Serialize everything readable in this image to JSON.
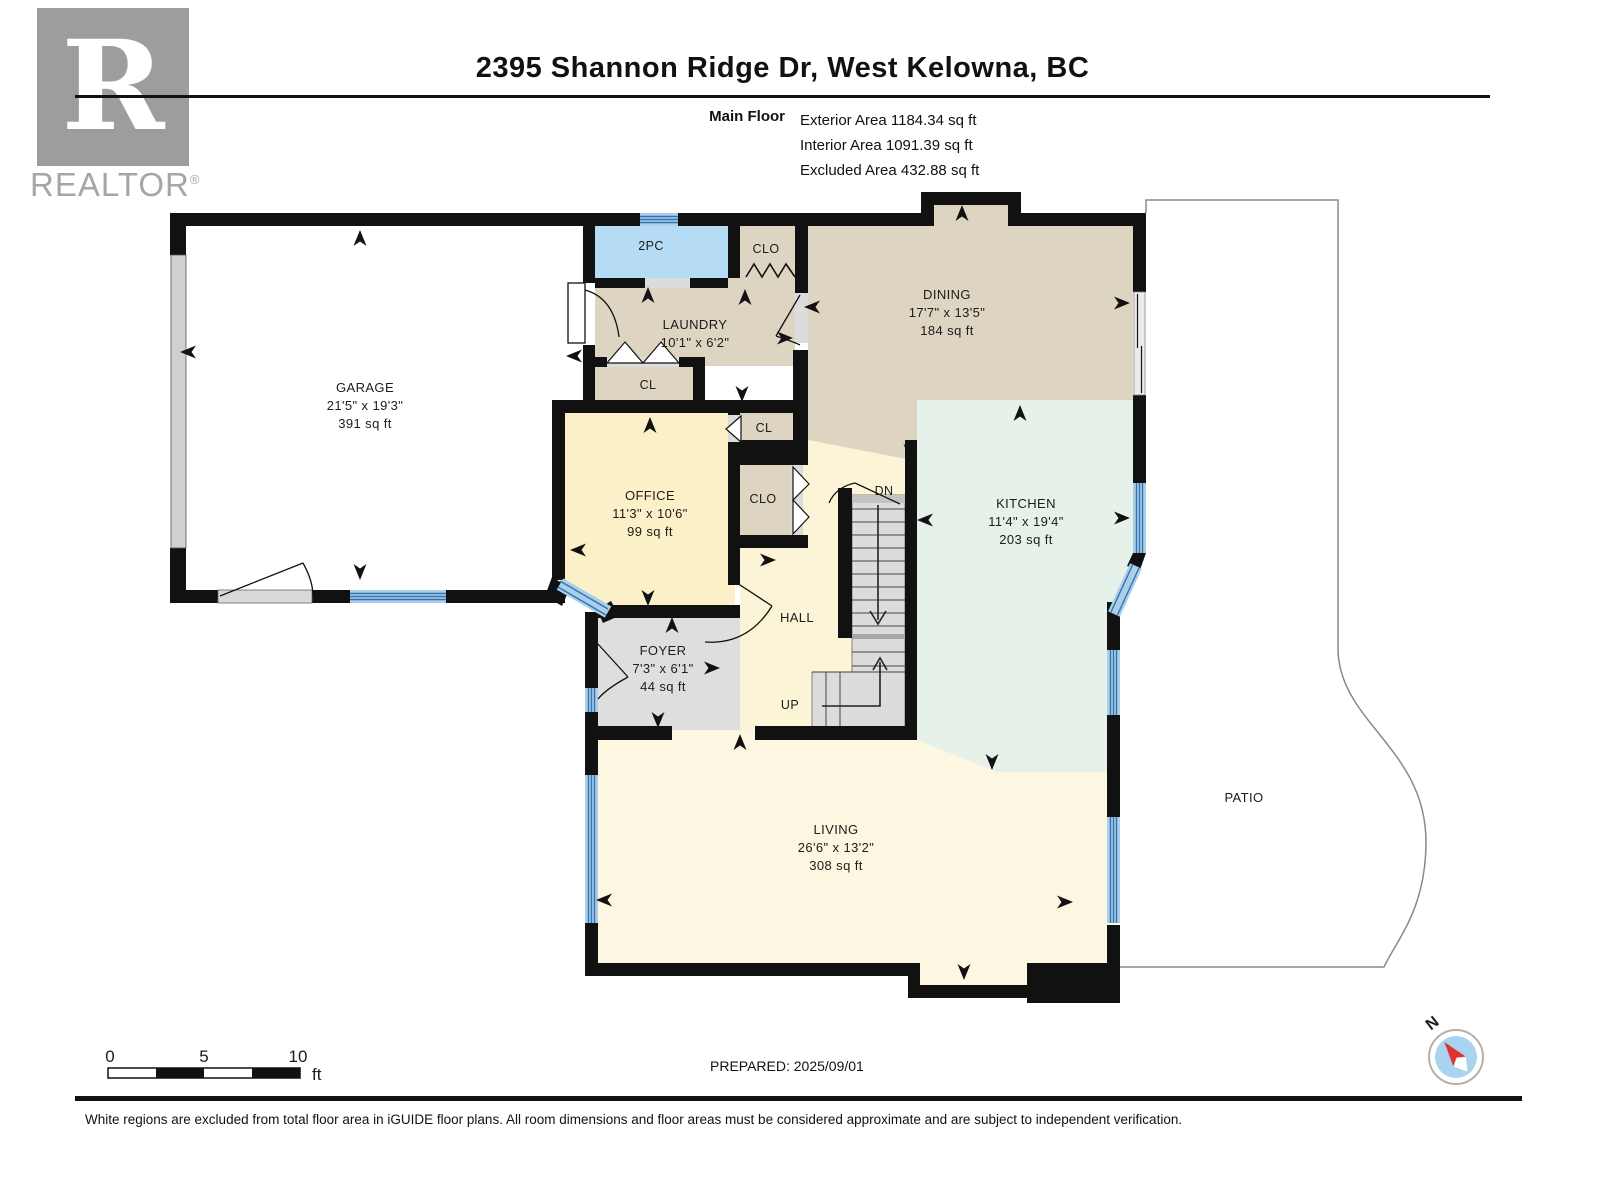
{
  "header": {
    "address": "2395 Shannon Ridge Dr, West Kelowna, BC",
    "floor_label": "Main Floor",
    "stats": [
      "Exterior Area 1184.34 sq ft",
      "Interior Area 1091.39 sq ft",
      "Excluded Area 432.88 sq ft"
    ]
  },
  "logo": {
    "letter": "R",
    "brand": "REALTOR",
    "registered": "®"
  },
  "rooms": {
    "garage": {
      "name": "GARAGE",
      "dims": "21'5\" x 19'3\"",
      "area": "391 sq ft"
    },
    "two_pc": {
      "name": "2PC"
    },
    "clo_top": {
      "name": "CLO"
    },
    "laundry": {
      "name": "LAUNDRY",
      "dims": "10'1\" x 6'2\""
    },
    "cl_laundry": {
      "name": "CL"
    },
    "dining": {
      "name": "DINING",
      "dims": "17'7\" x 13'5\"",
      "area": "184 sq ft"
    },
    "cl_office": {
      "name": "CL"
    },
    "clo_hall": {
      "name": "CLO"
    },
    "office": {
      "name": "OFFICE",
      "dims": "11'3\" x 10'6\"",
      "area": "99 sq ft"
    },
    "kitchen": {
      "name": "KITCHEN",
      "dims": "11'4\" x 19'4\"",
      "area": "203 sq ft"
    },
    "hall": {
      "name": "HALL"
    },
    "foyer": {
      "name": "FOYER",
      "dims": "7'3\" x 6'1\"",
      "area": "44 sq ft"
    },
    "living": {
      "name": "LIVING",
      "dims": "26'6\" x 13'2\"",
      "area": "308 sq ft"
    },
    "patio": {
      "name": "PATIO"
    }
  },
  "stairs": {
    "up_label": "UP",
    "down_label": "DN"
  },
  "scale_bar": {
    "ticks": [
      "0",
      "5",
      "10"
    ],
    "unit": "ft"
  },
  "compass": {
    "north_label": "N"
  },
  "footer": {
    "prepared": "PREPARED: 2025/09/01",
    "disclaimer": "White regions are excluded from total floor area in iGUIDE floor plans. All room dimensions and floor areas must be considered approximate and are subject to independent verification."
  },
  "colors": {
    "wall": "#111111",
    "beige_room": "#ddd4c2",
    "bath_blue": "#b5dcf4",
    "office_yellow": "#fbf0c7",
    "hall_yellow": "#fcf4d6",
    "living_cream": "#fdf6e0",
    "kitchen_mint": "#e6f1ea",
    "foyer_gray": "#dedede",
    "stair_gray": "#dcdcdc",
    "window_blue": "#a9cfea",
    "window_stripe": "#3572b0",
    "compass_blue": "#a8d4f0",
    "compass_red": "#e03131",
    "logo_gray": "#9d9d9d"
  }
}
